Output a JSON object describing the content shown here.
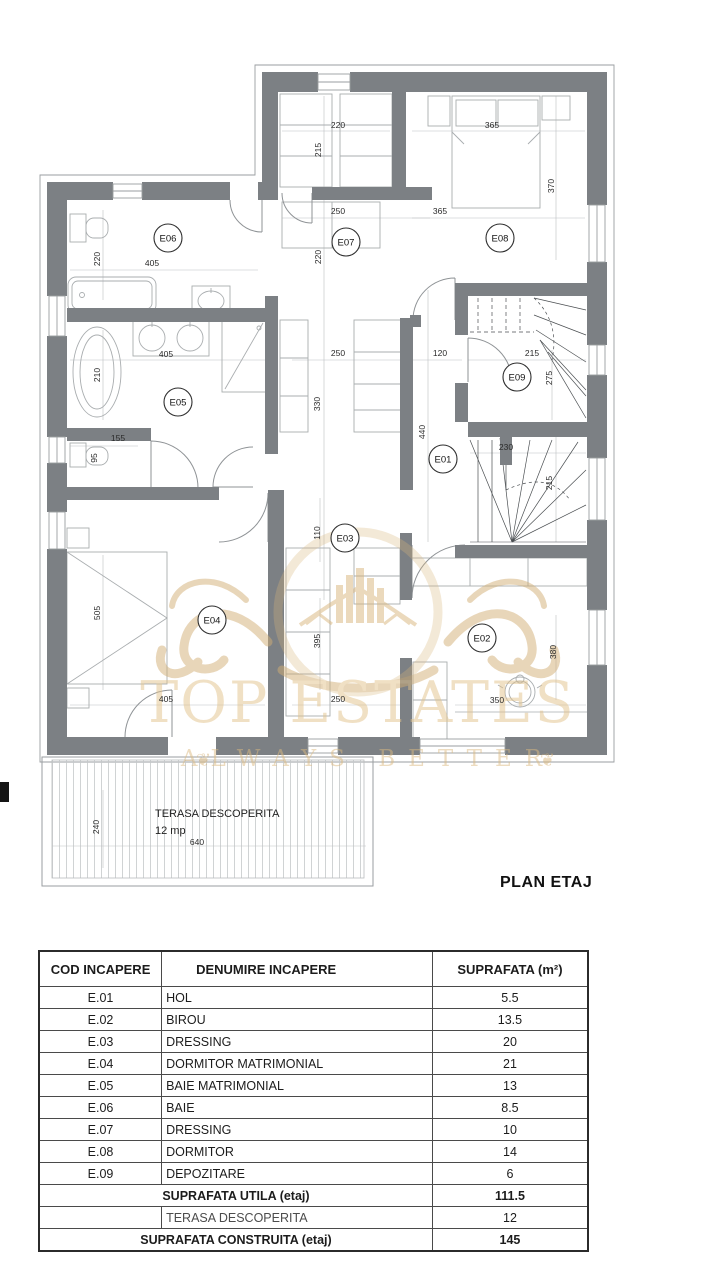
{
  "plan": {
    "title": "PLAN ETAJ",
    "wall_color": "#7c8084",
    "room_codes": [
      {
        "id": "E06",
        "x": 168,
        "y": 238
      },
      {
        "id": "E07",
        "x": 346,
        "y": 242
      },
      {
        "id": "E08",
        "x": 500,
        "y": 238
      },
      {
        "id": "E05",
        "x": 178,
        "y": 402
      },
      {
        "id": "E09",
        "x": 517,
        "y": 377
      },
      {
        "id": "E01",
        "x": 443,
        "y": 459
      },
      {
        "id": "E03",
        "x": 345,
        "y": 538
      },
      {
        "id": "E04",
        "x": 212,
        "y": 620
      },
      {
        "id": "E02",
        "x": 482,
        "y": 638
      }
    ],
    "dim_labels": [
      {
        "t": "220",
        "x": 338,
        "y": 128
      },
      {
        "t": "215",
        "x": 321,
        "y": 150,
        "rot": true
      },
      {
        "t": "365",
        "x": 492,
        "y": 128
      },
      {
        "t": "370",
        "x": 554,
        "y": 186,
        "rot": true
      },
      {
        "t": "250",
        "x": 338,
        "y": 214
      },
      {
        "t": "365",
        "x": 440,
        "y": 214
      },
      {
        "t": "220",
        "x": 100,
        "y": 259,
        "rot": true
      },
      {
        "t": "405",
        "x": 152,
        "y": 266
      },
      {
        "t": "220",
        "x": 321,
        "y": 257,
        "rot": true
      },
      {
        "t": "405",
        "x": 166,
        "y": 357
      },
      {
        "t": "210",
        "x": 100,
        "y": 375,
        "rot": true
      },
      {
        "t": "155",
        "x": 118,
        "y": 441
      },
      {
        "t": "95",
        "x": 97,
        "y": 458,
        "rot": true
      },
      {
        "t": "250",
        "x": 338,
        "y": 356
      },
      {
        "t": "120",
        "x": 440,
        "y": 356
      },
      {
        "t": "215",
        "x": 532,
        "y": 356
      },
      {
        "t": "330",
        "x": 320,
        "y": 404,
        "rot": true
      },
      {
        "t": "440",
        "x": 425,
        "y": 432,
        "rot": true
      },
      {
        "t": "275",
        "x": 552,
        "y": 378,
        "rot": true
      },
      {
        "t": "230",
        "x": 506,
        "y": 450
      },
      {
        "t": "215",
        "x": 552,
        "y": 483,
        "rot": true
      },
      {
        "t": "110",
        "x": 320,
        "y": 533,
        "rot": true
      },
      {
        "t": "505",
        "x": 100,
        "y": 613,
        "rot": true
      },
      {
        "t": "395",
        "x": 320,
        "y": 641,
        "rot": true
      },
      {
        "t": "380",
        "x": 556,
        "y": 652,
        "rot": true
      },
      {
        "t": "405",
        "x": 166,
        "y": 702
      },
      {
        "t": "250",
        "x": 338,
        "y": 702
      },
      {
        "t": "350",
        "x": 497,
        "y": 703
      },
      {
        "t": "240",
        "x": 99,
        "y": 827,
        "rot": true
      },
      {
        "t": "640",
        "x": 197,
        "y": 845
      }
    ],
    "terrace": {
      "line1": "TERASA DESCOPERITA",
      "line2": "12 mp"
    }
  },
  "watermark": {
    "line1": "TOP ESTATES",
    "line2": "ALWAYS BETTER",
    "color": "#e2c28b"
  },
  "table": {
    "headers": [
      "COD INCAPERE",
      "DENUMIRE INCAPERE",
      "SUPRAFATA (m²)"
    ],
    "rows": [
      {
        "cod": "E.01",
        "name": "HOL",
        "area": "5.5"
      },
      {
        "cod": "E.02",
        "name": "BIROU",
        "area": "13.5"
      },
      {
        "cod": "E.03",
        "name": "DRESSING",
        "area": "20"
      },
      {
        "cod": "E.04",
        "name": "DORMITOR MATRIMONIAL",
        "area": "21"
      },
      {
        "cod": "E.05",
        "name": "BAIE MATRIMONIAL",
        "area": "13"
      },
      {
        "cod": "E.06",
        "name": "BAIE",
        "area": "8.5"
      },
      {
        "cod": "E.07",
        "name": "DRESSING",
        "area": "10"
      },
      {
        "cod": "E.08",
        "name": "DORMITOR",
        "area": "14"
      },
      {
        "cod": "E.09",
        "name": "DEPOZITARE",
        "area": "6"
      }
    ],
    "footer": [
      {
        "label": "SUPRAFATA UTILA (etaj)",
        "value": "111.5",
        "style": "bold"
      },
      {
        "label": "TERASA DESCOPERITA",
        "value": "12",
        "style": "terasa"
      },
      {
        "label": "SUPRAFATA CONSTRUITA (etaj)",
        "value": "145",
        "style": "last"
      }
    ]
  }
}
